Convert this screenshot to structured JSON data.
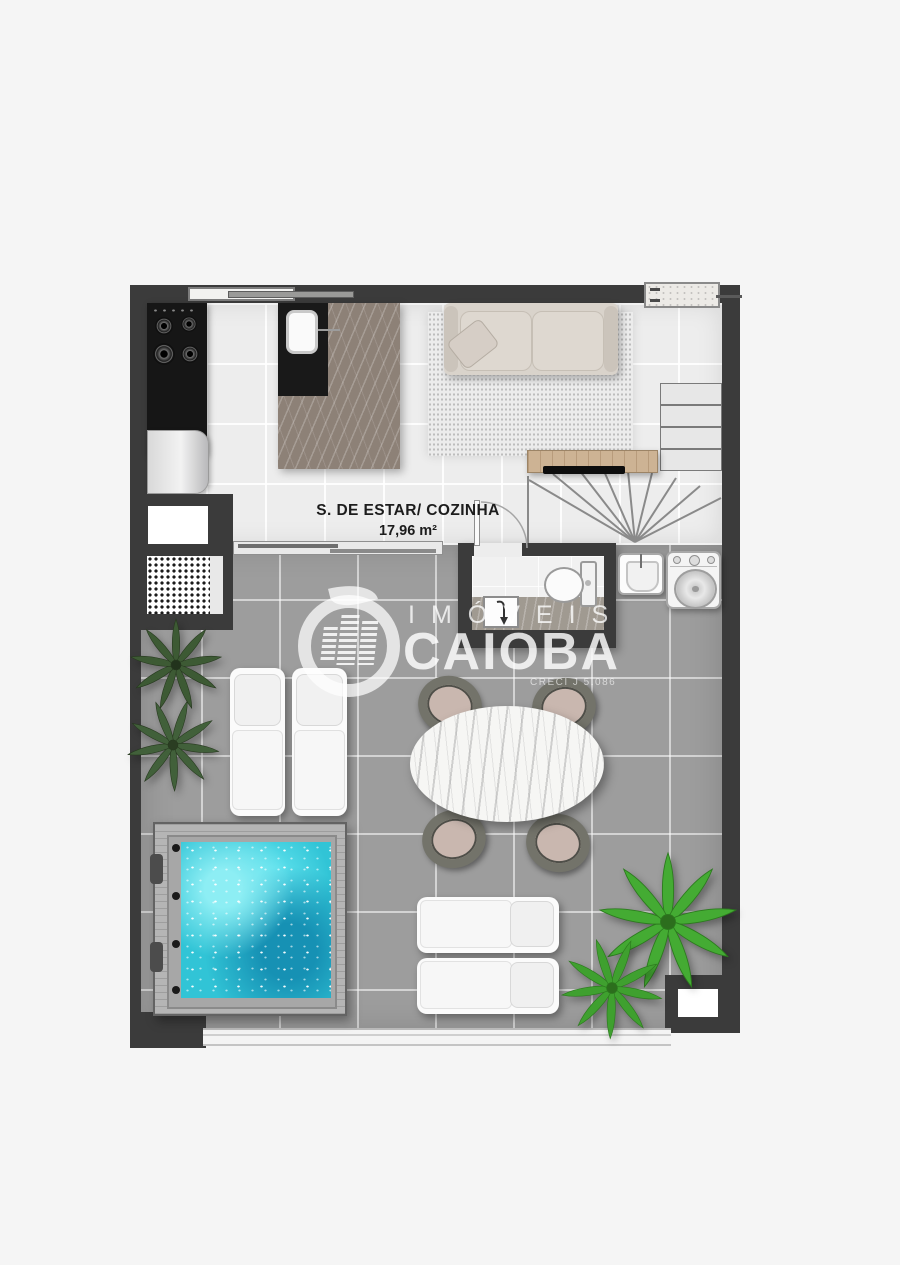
{
  "page": {
    "background_color": "#f5f5f5"
  },
  "plan": {
    "room_label": "S. DE ESTAR/ COZINHA",
    "room_area": "17,96 m²",
    "colors": {
      "wall": "#3b3b3b",
      "indoor_floor": "#ededed",
      "terrace_floor": "#9d9d9d",
      "hot_tub_water": "#31c4d6",
      "island_marble": "#8d8177",
      "console_wood": "#cdb394",
      "plant_dark_green": "#3d5a34",
      "plant_bright_green": "#44ab33",
      "sofa_beige": "#d9d3cb"
    },
    "furniture_icons": [
      "cooktop-icon",
      "refrigerator-icon",
      "island-sink-icon",
      "bar-stool-icon",
      "sofa-icon",
      "rug-icon",
      "tv-console-icon",
      "staircase-icon",
      "toilet-icon",
      "bathroom-sink-icon",
      "laundry-tank-icon",
      "washing-machine-icon",
      "hot-tub-icon",
      "sun-lounger-icon",
      "dining-table-icon",
      "dining-chair-icon",
      "plant-icon",
      "window-icon",
      "sliding-door-icon",
      "shelf-icon"
    ]
  },
  "watermark": {
    "brand_top": "IMÓVEIS",
    "brand_main": "CAIOBA",
    "subtext": "CRECI J 5.086"
  }
}
